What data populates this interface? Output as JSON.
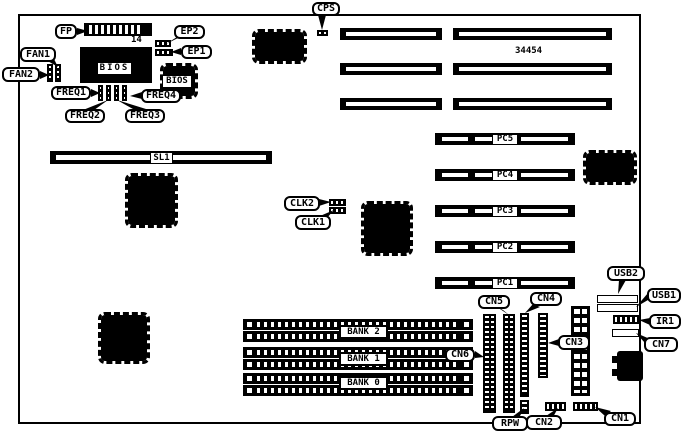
{
  "figure": {
    "kind": "motherboard layout diagram",
    "part_number": "34454",
    "pin_marker": "14",
    "colors": {
      "ink": "#000000",
      "paper": "#ffffff"
    },
    "labels": {
      "fp": "FP",
      "ep1": "EP1",
      "ep2": "EP2",
      "fan1": "FAN1",
      "fan2": "FAN2",
      "bios_rom": "BIOS",
      "bios_flash": "BIOS",
      "freq1": "FREQ1",
      "freq2": "FREQ2",
      "freq3": "FREQ3",
      "freq4": "FREQ4",
      "cps": "CPS",
      "sl1": "SL1",
      "clk1": "CLK1",
      "clk2": "CLK2",
      "pc1": "PC1",
      "pc2": "PC2",
      "pc3": "PC3",
      "pc4": "PC4",
      "pc5": "PC5",
      "bank0": "BANK 0",
      "bank1": "BANK 1",
      "bank2": "BANK 2",
      "cn1": "CN1",
      "cn2": "CN2",
      "cn3": "CN3",
      "cn4": "CN4",
      "cn5": "CN5",
      "cn6": "CN6",
      "cn7": "CN7",
      "usb1": "USB1",
      "usb2": "USB2",
      "ir1": "IR1",
      "rpw": "RPW"
    }
  }
}
